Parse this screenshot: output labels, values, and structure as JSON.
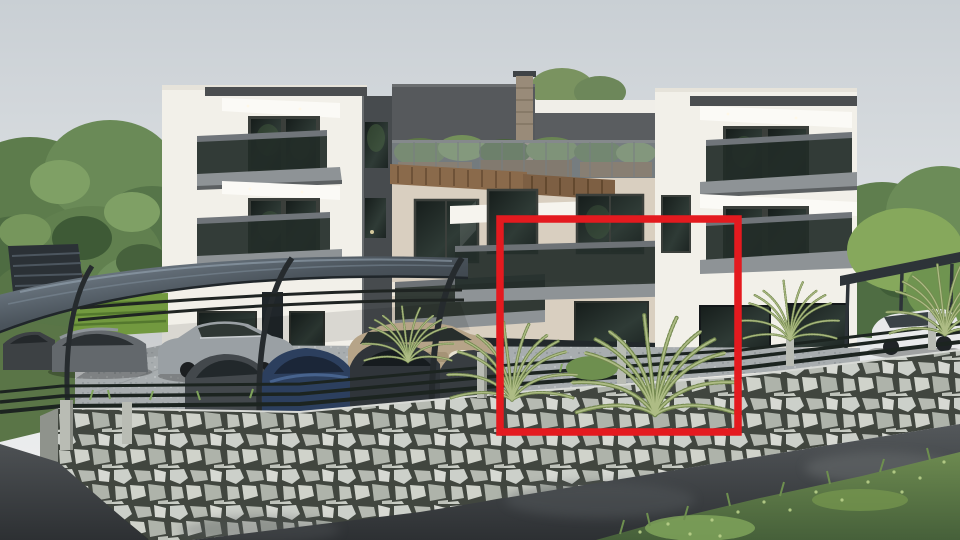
{
  "page": {
    "title": "3D exterior rendering of a modern three-storey apartment building with a red outline marking one unit"
  },
  "highlight": {
    "color": "#e41a1f",
    "shape": "rectangle",
    "meaning": "red outline annotation marking the apartment unit for sale (ground + first floor, centre-right of building)"
  },
  "palette": {
    "sky": "#d9dde0",
    "facade_white": "#f2f0e9",
    "facade_cream": "#d9cfc0",
    "penthouse_dark": "#56595c",
    "roof_fascia": "#4b4e50",
    "wood_pergola": "#8a6a4b",
    "glass_dark": "#232d2a",
    "balcony_slab": "#8e9396",
    "carport_canopy": "#39414a",
    "stone_wall": "#c4c8c2",
    "stone_mortar": "#41463f",
    "asphalt_road": "#3c4043",
    "grass_green": "#5c7a45",
    "tree_green": "#5f7f4e",
    "fern_green": "#9aad72",
    "car_silver": "#9aa0a4",
    "car_beige": "#b6a488",
    "car_navy": "#2c3f5e",
    "car_white": "#e9eaeb"
  },
  "scene": {
    "objects": [
      "overcast sky",
      "large trees left and right",
      "three-storey apartment building with white and cream facade",
      "dark penthouse level with roof terrace, glass railing, planters and chimney",
      "wood pergola awnings over first-floor windows",
      "balconies with tinted glass railings",
      "curved-frame carport with dark canopy",
      "parked cars (dark, silver, beige, navy, white)",
      "palm ferns in front garden",
      "stone retaining wall with dark metal fence and concrete posts",
      "asphalt road in foreground",
      "grass verge bottom right",
      "red rectangle annotation around highlighted unit"
    ]
  }
}
